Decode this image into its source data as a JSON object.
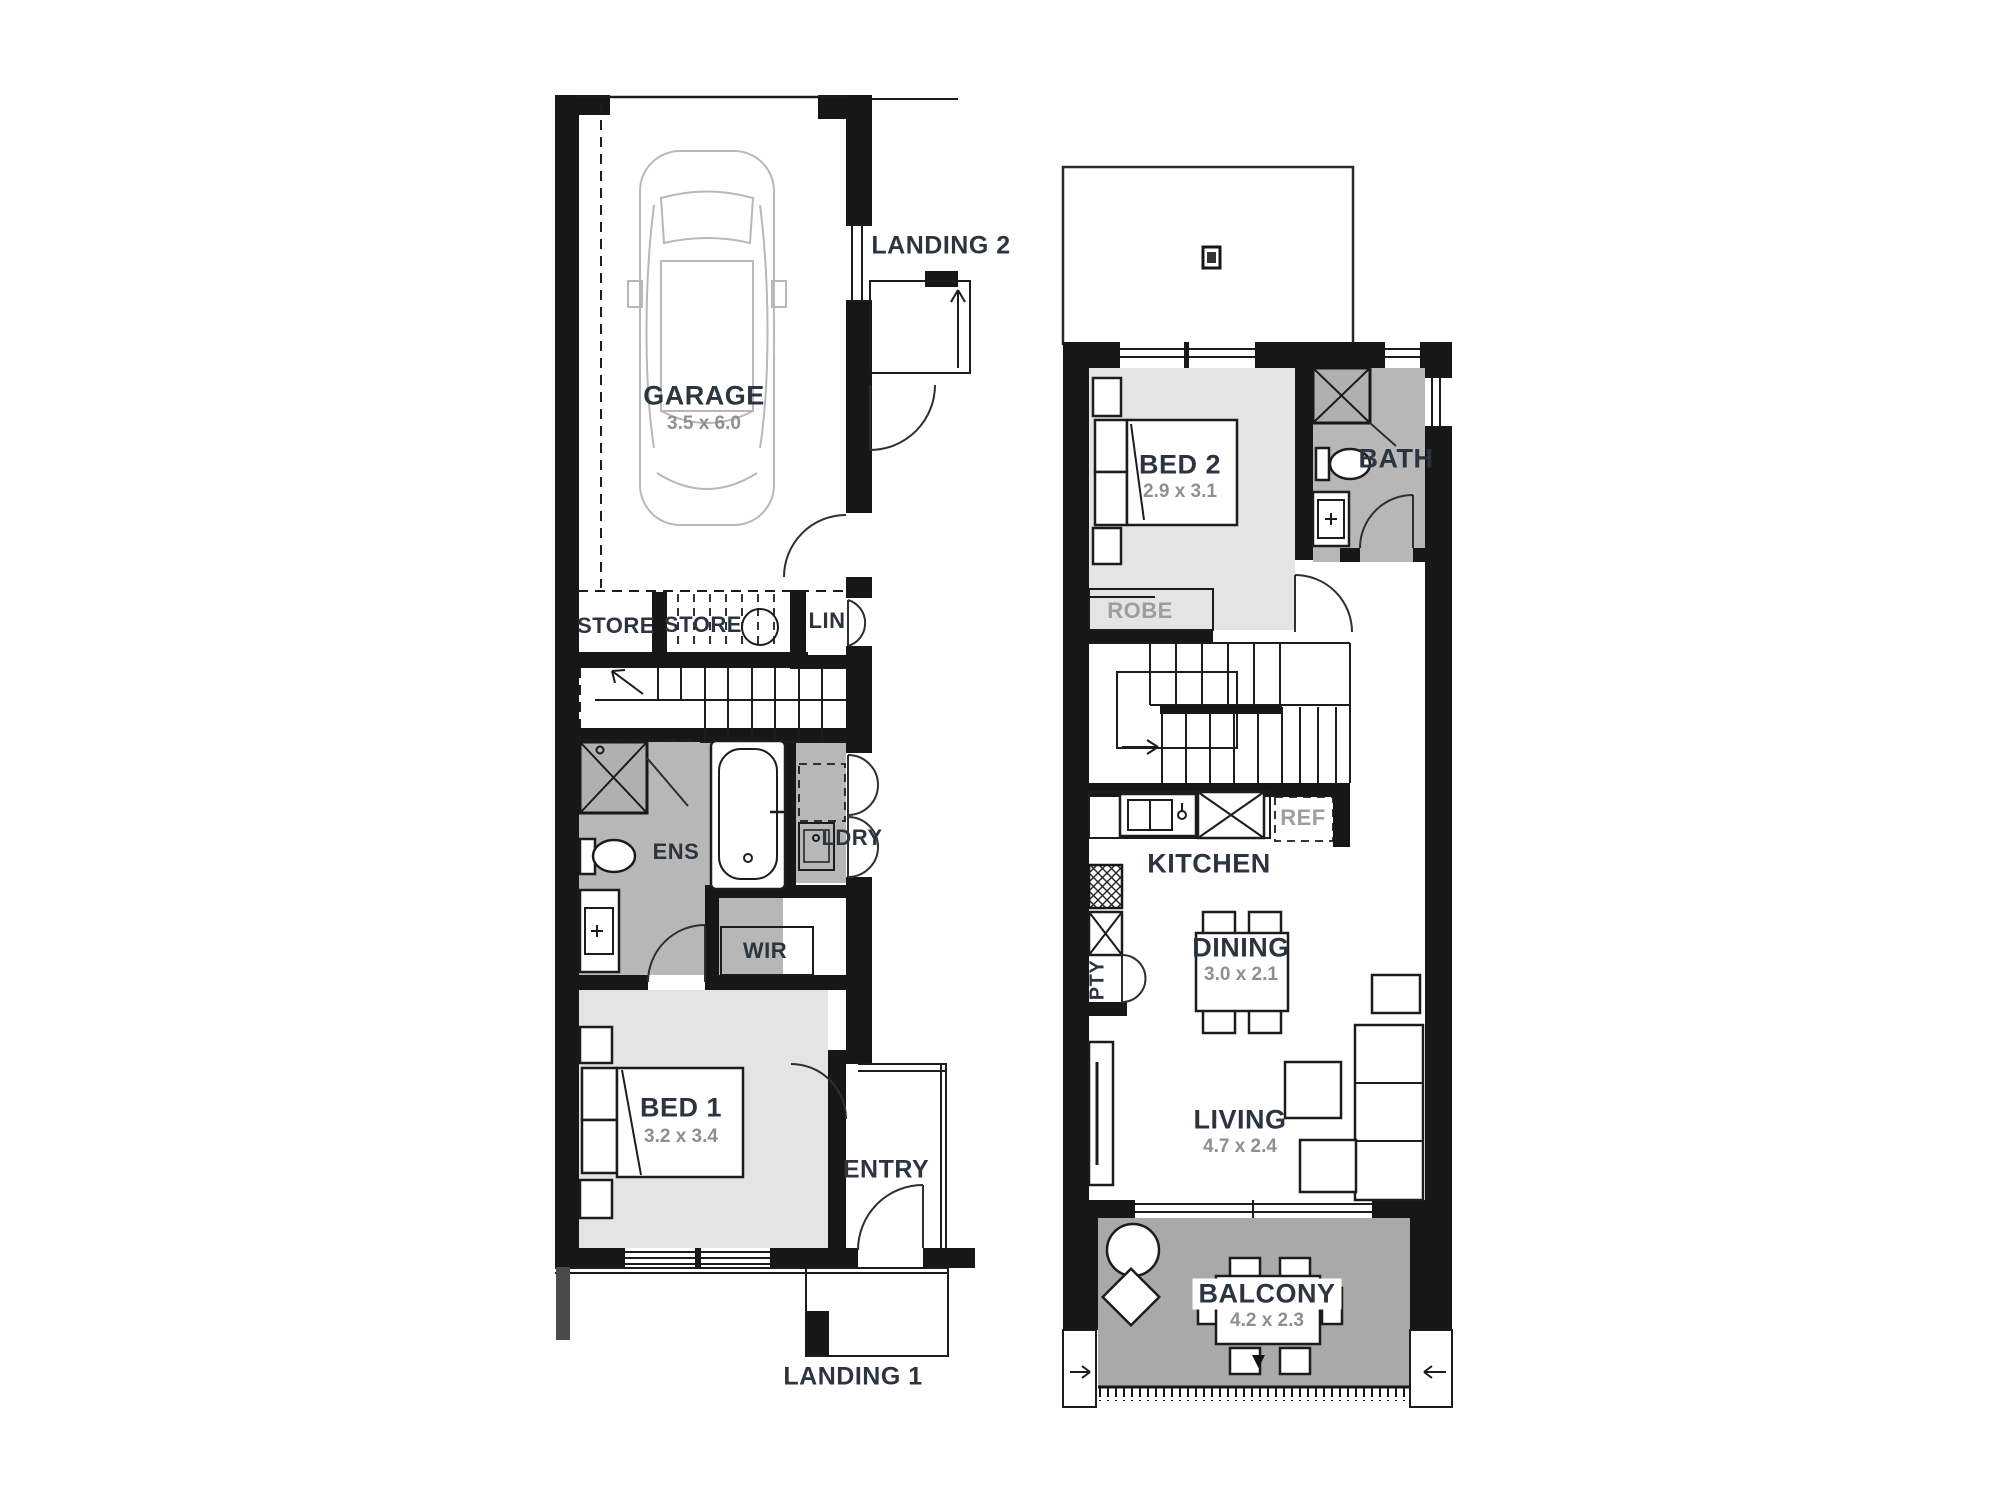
{
  "colors": {
    "wall": "#171717",
    "line": "#1c1c1c",
    "room_light": "#e4e4e4",
    "room_wet": "#b7b7b7",
    "balcony": "#a9a9a9",
    "label": "#2c3440",
    "label_gray": "#9e9e9e",
    "dim": "#8f8f8f",
    "car": "#b8b8b8"
  },
  "ground_floor": {
    "garage": {
      "label": "GARAGE",
      "dim": "3.5 x 6.0"
    },
    "landing2": {
      "label": "LANDING 2"
    },
    "store1": {
      "label": "STORE"
    },
    "store2": {
      "label": "STORE"
    },
    "lin": {
      "label": "LIN"
    },
    "ens": {
      "label": "ENS"
    },
    "ldry": {
      "label": "LDRY"
    },
    "wir": {
      "label": "WIR"
    },
    "bed1": {
      "label": "BED 1",
      "dim": "3.2 x 3.4"
    },
    "entry": {
      "label": "ENTRY"
    },
    "landing1": {
      "label": "LANDING 1"
    }
  },
  "upper_floor": {
    "bed2": {
      "label": "BED 2",
      "dim": "2.9 x 3.1"
    },
    "bath": {
      "label": "BATH"
    },
    "robe": {
      "label": "ROBE"
    },
    "kitchen": {
      "label": "KITCHEN"
    },
    "ref": {
      "label": "REF"
    },
    "pty": {
      "label": "PTY"
    },
    "dining": {
      "label": "DINING",
      "dim": "3.0 x 2.1"
    },
    "living": {
      "label": "LIVING",
      "dim": "4.7 x 2.4"
    },
    "balcony": {
      "label": "BALCONY",
      "dim": "4.2 x 2.3"
    }
  }
}
